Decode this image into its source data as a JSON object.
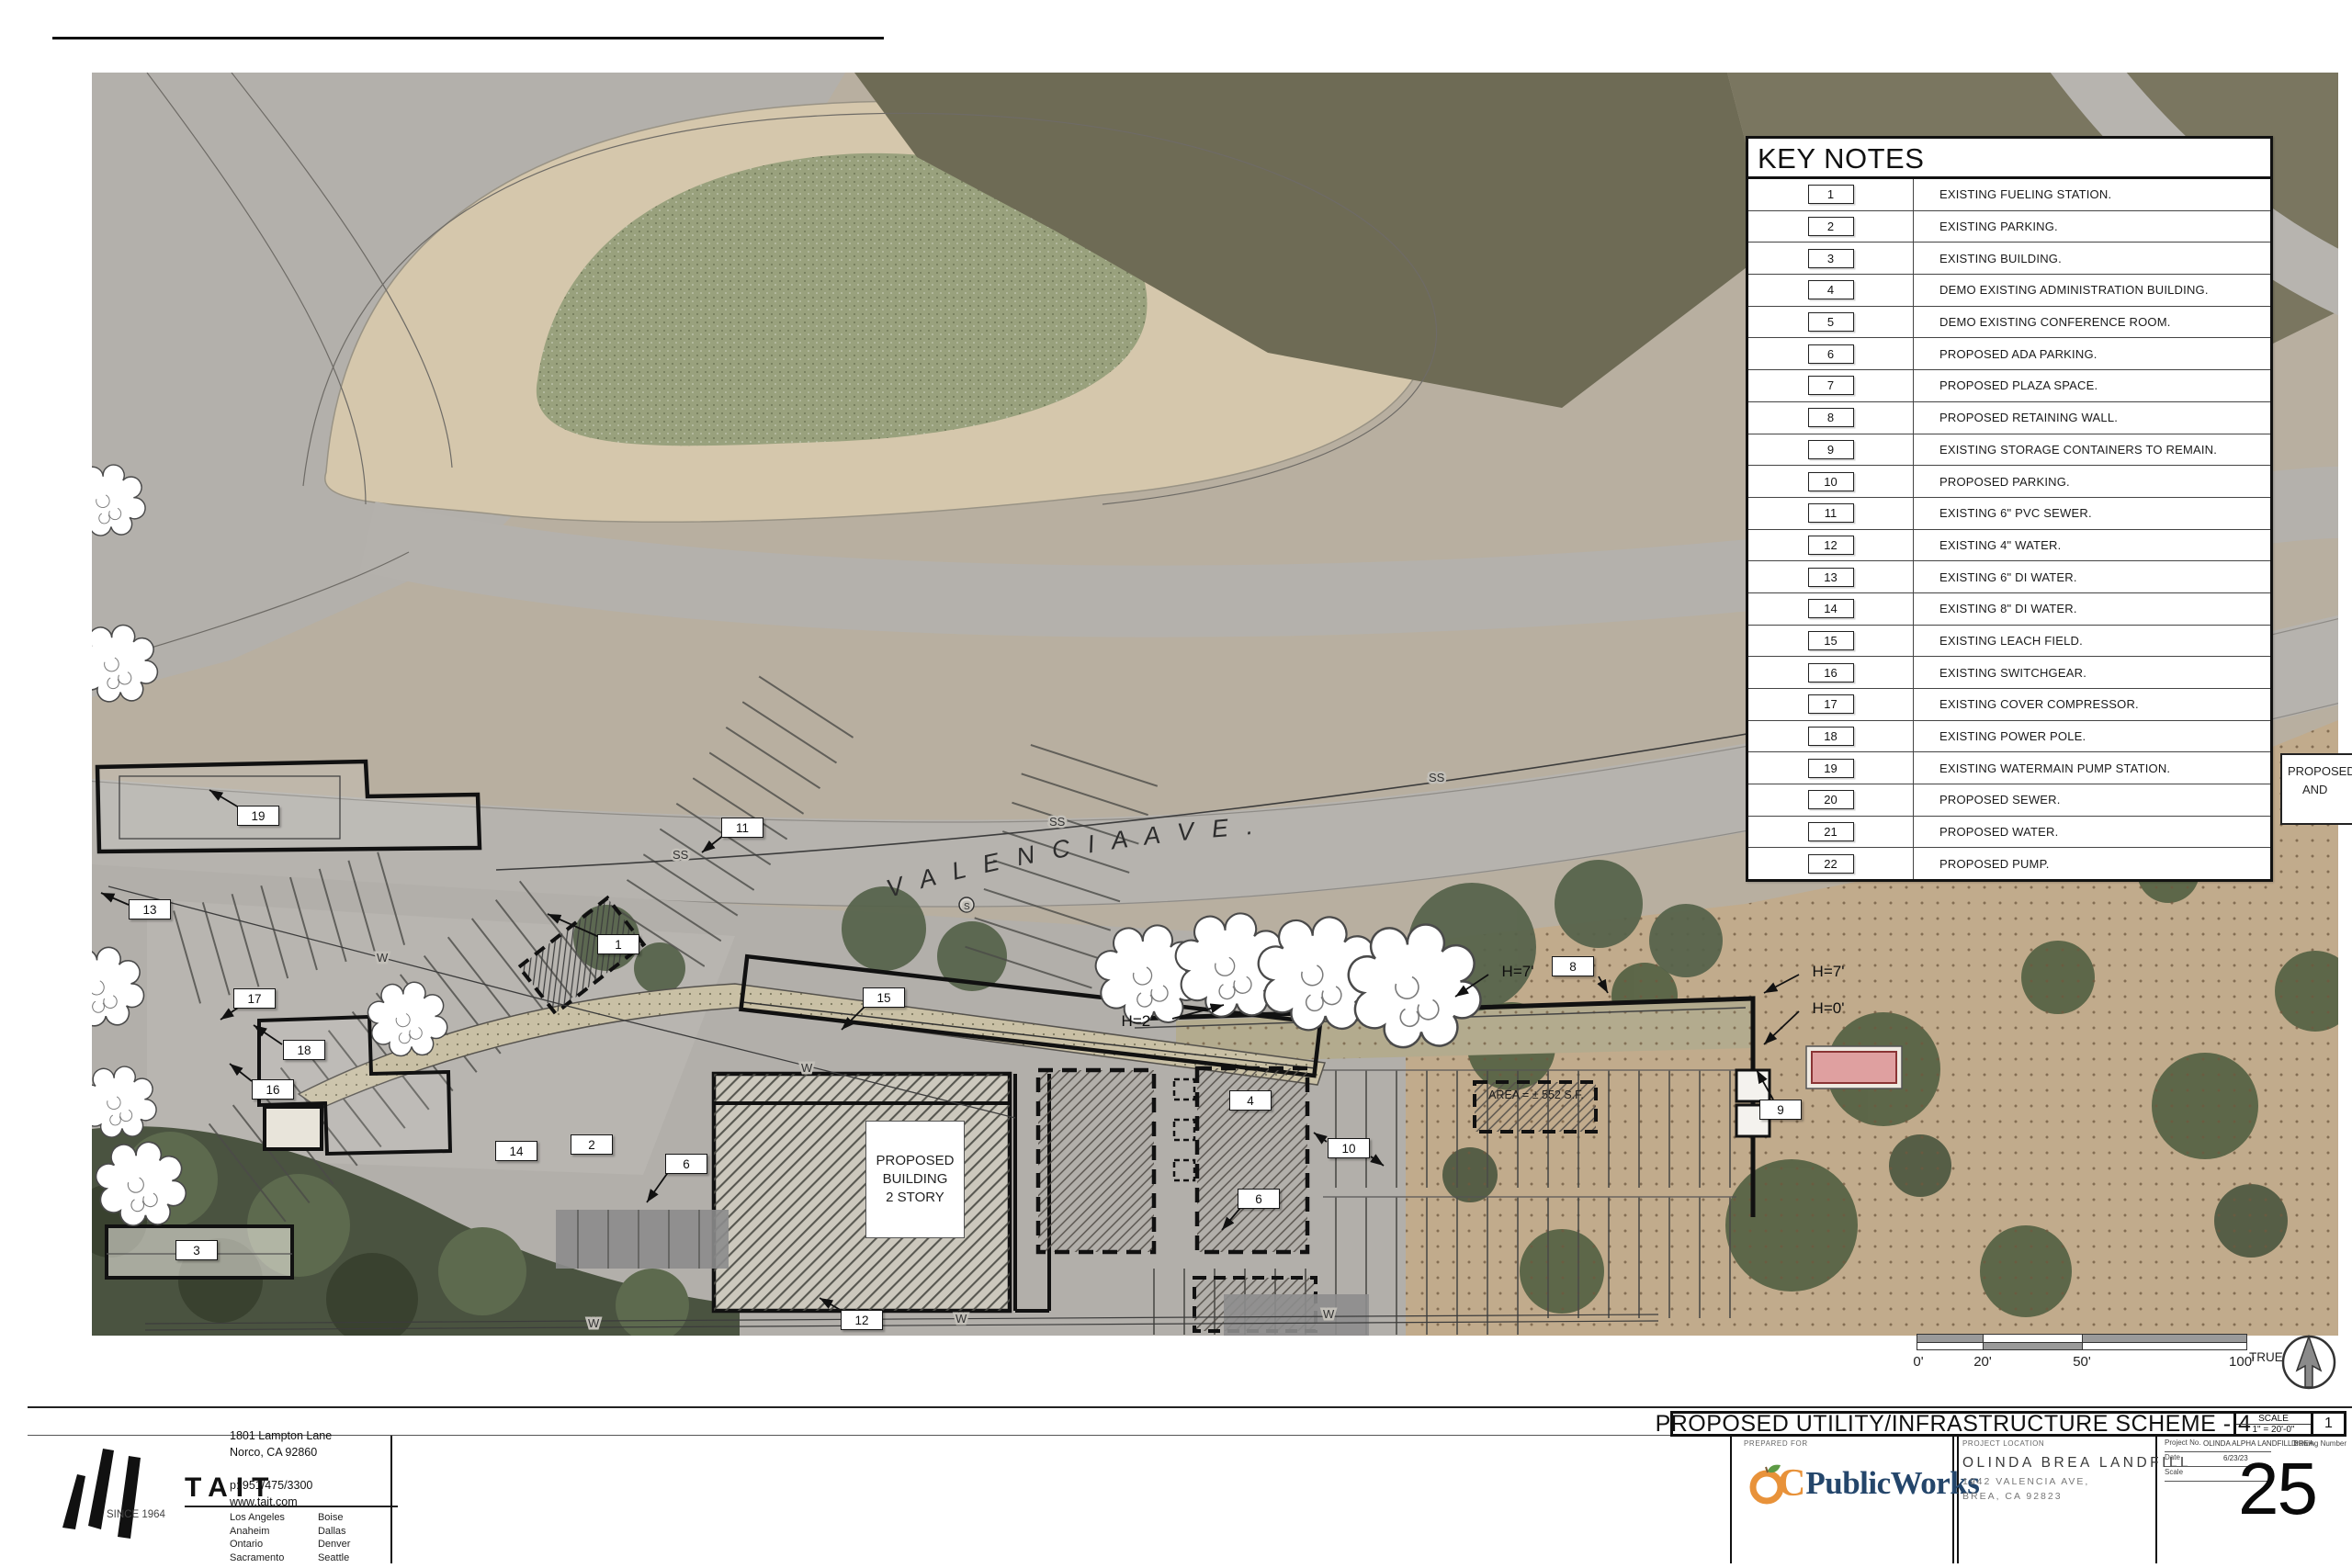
{
  "page": {
    "key_notes": {
      "title": "KEY NOTES",
      "items": [
        {
          "num": "1",
          "text": "EXISTING FUELING STATION."
        },
        {
          "num": "2",
          "text": "EXISTING PARKING."
        },
        {
          "num": "3",
          "text": "EXISTING BUILDING."
        },
        {
          "num": "4",
          "text": "DEMO EXISTING ADMINISTRATION BUILDING."
        },
        {
          "num": "5",
          "text": "DEMO EXISTING CONFERENCE ROOM."
        },
        {
          "num": "6",
          "text": "PROPOSED ADA PARKING."
        },
        {
          "num": "7",
          "text": "PROPOSED PLAZA SPACE."
        },
        {
          "num": "8",
          "text": "PROPOSED RETAINING WALL."
        },
        {
          "num": "9",
          "text": "EXISTING STORAGE CONTAINERS TO REMAIN."
        },
        {
          "num": "10",
          "text": "PROPOSED PARKING."
        },
        {
          "num": "11",
          "text": "EXISTING 6\" PVC SEWER."
        },
        {
          "num": "12",
          "text": "EXISTING 4\" WATER."
        },
        {
          "num": "13",
          "text": "EXISTING 6\" DI WATER."
        },
        {
          "num": "14",
          "text": "EXISTING 8\" DI WATER."
        },
        {
          "num": "15",
          "text": "EXISTING LEACH FIELD."
        },
        {
          "num": "16",
          "text": "EXISTING SWITCHGEAR."
        },
        {
          "num": "17",
          "text": "EXISTING COVER COMPRESSOR."
        },
        {
          "num": "18",
          "text": "EXISTING POWER POLE."
        },
        {
          "num": "19",
          "text": "EXISTING WATERMAIN PUMP STATION."
        },
        {
          "num": "20",
          "text": "PROPOSED SEWER."
        },
        {
          "num": "21",
          "text": "PROPOSED WATER."
        },
        {
          "num": "22",
          "text": "PROPOSED PUMP."
        }
      ]
    },
    "plan": {
      "street_label": "V A L E N C I A   A V E .",
      "building_label_line1": "PROPOSED",
      "building_label_line2": "BUILDING",
      "building_label_line3": "2 STORY",
      "area_label": "AREA = ± 552 S.F.",
      "partial_note_line1": "PROPOSED",
      "partial_note_line2": "AND",
      "h2": "H=2'",
      "h7_center": "H=7'",
      "h7_right": "H=7'",
      "h0_right": "H=0'",
      "water_label": "W",
      "sewer_label": "SS",
      "manhole_label": "S",
      "refs": [
        "19",
        "13",
        "17",
        "18",
        "16",
        "3",
        "14",
        "2",
        "6",
        "1",
        "11",
        "15",
        "12",
        "4",
        "6",
        "10",
        "8",
        "9"
      ]
    },
    "scale_bar": {
      "tick0": "0'",
      "tick20": "20'",
      "tick50": "50'",
      "tick100": "100'",
      "true_label": "TRUE"
    },
    "title_bar": {
      "title": "PROPOSED UTILITY/INFRASTRUCTURE SCHEME - 4",
      "scale_label": "SCALE",
      "scale_value": "1\" = 20'-0\"",
      "detail_number": "1"
    },
    "title_block": {
      "tait": {
        "name": "TAIT",
        "since": "SINCE 1964",
        "address_line1": "1801 Lampton Lane",
        "address_line2": "Norco, CA 92860",
        "phone": "p: 951/475/3300",
        "website": "www.tait.com",
        "cities_left": [
          "Los Angeles",
          "Anaheim",
          "Ontario",
          "Sacramento"
        ],
        "cities_right": [
          "Boise",
          "Dallas",
          "Denver",
          "Seattle"
        ]
      },
      "prepared_for_label": "PREPARED FOR",
      "oc_logo": {
        "c": "C",
        "rest": "PublicWorks"
      },
      "project_location_label": "PROJECT LOCATION",
      "project_name": "OLINDA BREA LANDFILL",
      "project_address1": "1942 VALENCIA AVE,",
      "project_address2": "BREA, CA 92823",
      "info": {
        "project_no_label": "Project No.",
        "project_no_value": "OLINDA ALPHA LANDFILL BREA",
        "drawing_number_label": "Drawing Number",
        "date_label": "Date",
        "date_value": "6/23/23",
        "scale_label": "Scale",
        "sheet_number": "25"
      }
    },
    "colors": {
      "accent_orange": "#e8923a",
      "brand_navy": "#24466b",
      "highlight_pink": "#dfa0a0"
    }
  }
}
